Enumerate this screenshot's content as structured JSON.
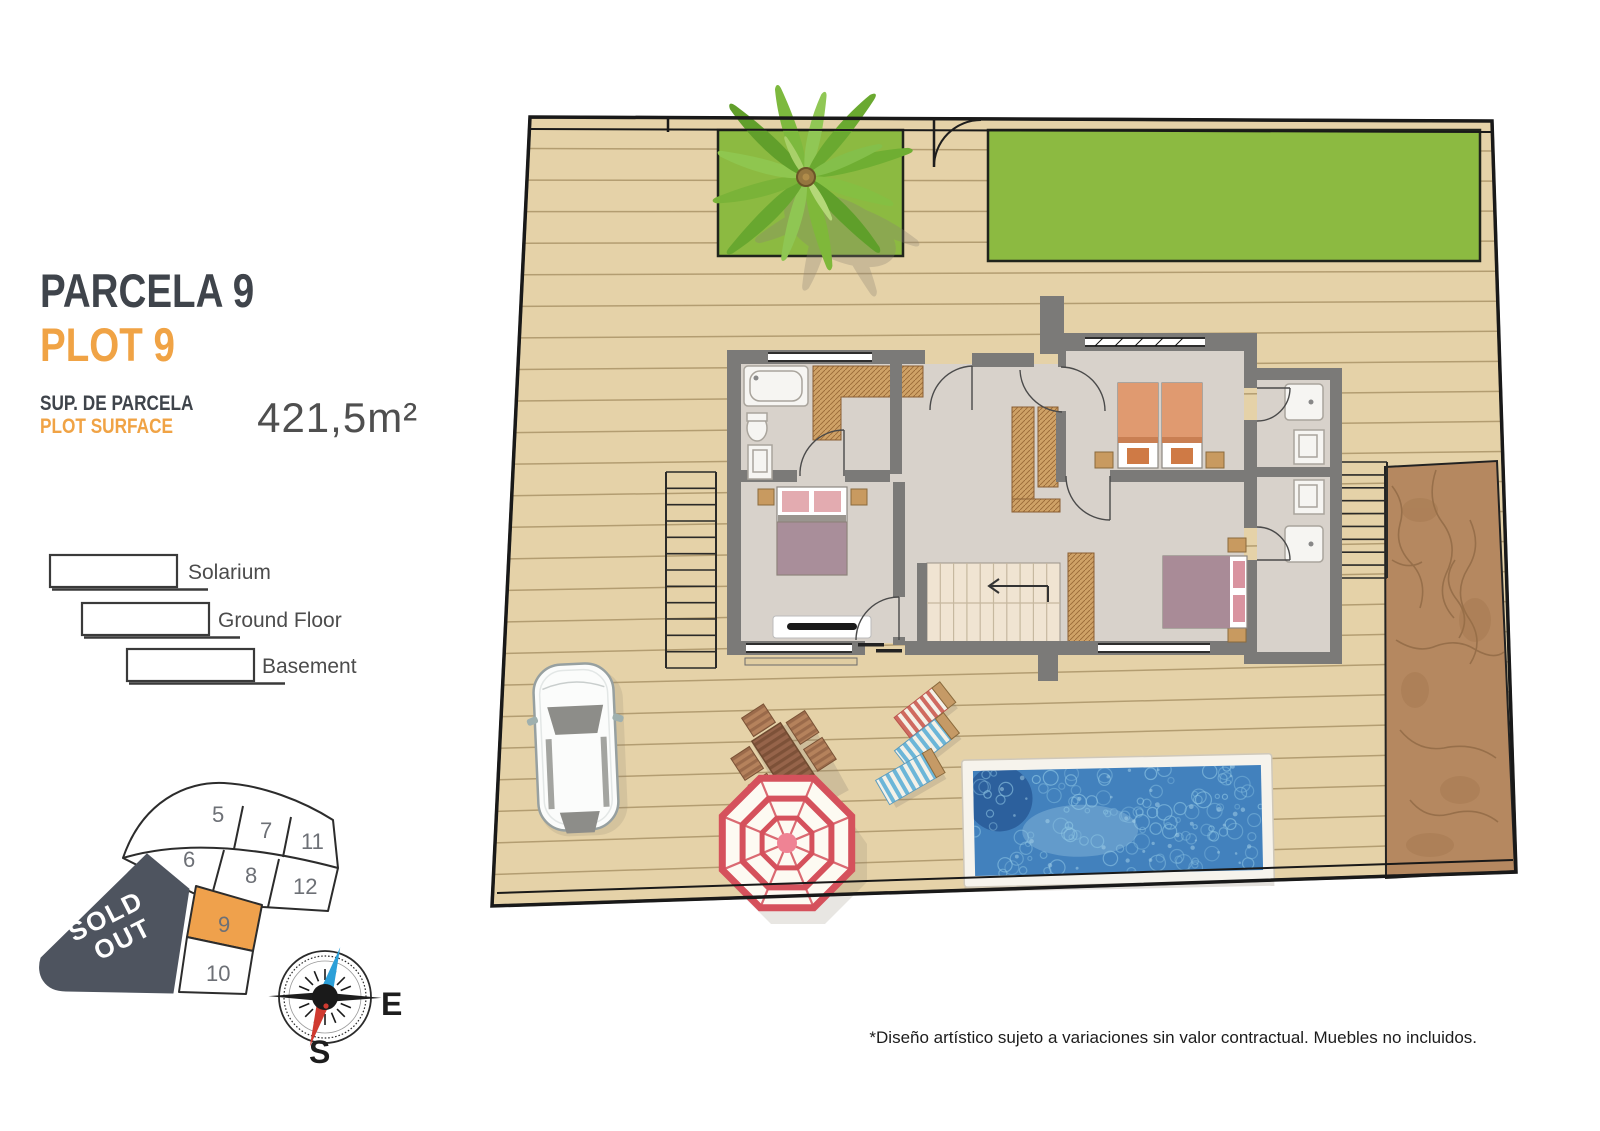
{
  "panel": {
    "title_primary": "PARCELA 9",
    "title_secondary": "PLOT 9",
    "surface_label_primary": "SUP. DE PARCELA",
    "surface_label_secondary": "PLOT SURFACE",
    "surface_value": "421,5m²",
    "legend": [
      {
        "label": "Solarium"
      },
      {
        "label": "Ground Floor"
      },
      {
        "label": "Basement"
      }
    ]
  },
  "plot_map": {
    "sold_out_line1": "SOLD",
    "sold_out_line2": "OUT",
    "selected_plot": "9",
    "cells": [
      {
        "label": "5"
      },
      {
        "label": "7"
      },
      {
        "label": "11"
      },
      {
        "label": "6"
      },
      {
        "label": "8"
      },
      {
        "label": "12"
      },
      {
        "label": "9"
      },
      {
        "label": "10"
      }
    ]
  },
  "compass": {
    "east": "E",
    "south": "S"
  },
  "disclaimer": "*Diseño artístico sujeto a variaciones sin valor contractual. Muebles no incluidos.",
  "colors": {
    "accent_orange": "#F0A345",
    "title_dark": "#3F444B",
    "sold_out_bg": "#4E545F",
    "plot9_orange": "#EFA14C",
    "grass": "#8CBA41",
    "deck": "#E5D2A8",
    "pool_water": "#4281BD",
    "dirt": "#B58860"
  }
}
